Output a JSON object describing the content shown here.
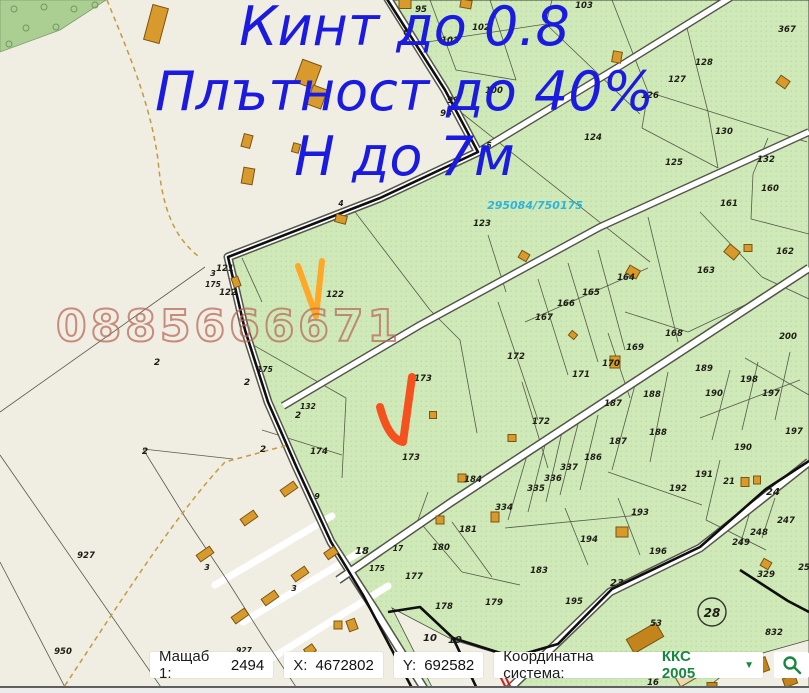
{
  "overlay": {
    "line1": "Кинт до 0.8",
    "line2": "Плътност до 40%",
    "line3": "Н до 7м",
    "note_color": "#1b1ae0",
    "watermark": "0885666671",
    "plot_id": "295084/750175",
    "check_orange": "#ffa726",
    "check_red": "#f4511e"
  },
  "map": {
    "colors": {
      "land": "#f0ede3",
      "parcel_green": "#cfe9b8",
      "forest": "#abce93",
      "road_fill": "#ffffff",
      "road_edge": "#53544a",
      "boundary": "#0f0f0f",
      "building": "#d89a2c",
      "label": "#1d1d15",
      "plot_id_color": "#2fb3d9"
    },
    "circled_parcel": "28",
    "labels": [
      {
        "t": "95",
        "x": 421,
        "y": 12
      },
      {
        "t": "102",
        "x": 481,
        "y": 30
      },
      {
        "t": "101",
        "x": 450,
        "y": 43
      },
      {
        "t": "103",
        "x": 584,
        "y": 8
      },
      {
        "t": "6",
        "x": 406,
        "y": 35,
        "s": 7.5
      },
      {
        "t": "100",
        "x": 494,
        "y": 93
      },
      {
        "t": "99",
        "x": 453,
        "y": 103
      },
      {
        "t": "98",
        "x": 446,
        "y": 116
      },
      {
        "t": "367",
        "x": 787,
        "y": 32
      },
      {
        "t": "128",
        "x": 704,
        "y": 65
      },
      {
        "t": "127",
        "x": 677,
        "y": 82
      },
      {
        "t": "126",
        "x": 650,
        "y": 98
      },
      {
        "t": "130",
        "x": 724,
        "y": 134
      },
      {
        "t": "5",
        "x": 489,
        "y": 148,
        "s": 8
      },
      {
        "t": "125",
        "x": 674,
        "y": 165
      },
      {
        "t": "124",
        "x": 593,
        "y": 140
      },
      {
        "t": "132",
        "x": 766,
        "y": 162
      },
      {
        "t": "160",
        "x": 770,
        "y": 191
      },
      {
        "t": "161",
        "x": 729,
        "y": 206
      },
      {
        "t": "162",
        "x": 785,
        "y": 254
      },
      {
        "t": "123",
        "x": 482,
        "y": 226
      },
      {
        "t": "4",
        "x": 341,
        "y": 206,
        "s": 7.5
      },
      {
        "t": "121",
        "x": 225,
        "y": 271
      },
      {
        "t": "3",
        "x": 213,
        "y": 276,
        "s": 8
      },
      {
        "t": "175",
        "x": 213,
        "y": 287,
        "s": 7.5
      },
      {
        "t": "122",
        "x": 228,
        "y": 295
      },
      {
        "t": "122",
        "x": 335,
        "y": 297
      },
      {
        "t": "163",
        "x": 706,
        "y": 273
      },
      {
        "t": "164",
        "x": 626,
        "y": 280
      },
      {
        "t": "165",
        "x": 591,
        "y": 295
      },
      {
        "t": "166",
        "x": 566,
        "y": 306
      },
      {
        "t": "167",
        "x": 544,
        "y": 320
      },
      {
        "t": "168",
        "x": 674,
        "y": 336
      },
      {
        "t": "169",
        "x": 635,
        "y": 350
      },
      {
        "t": "170",
        "x": 611,
        "y": 366
      },
      {
        "t": "171",
        "x": 581,
        "y": 377
      },
      {
        "t": "172",
        "x": 516,
        "y": 359
      },
      {
        "t": "172",
        "x": 541,
        "y": 424
      },
      {
        "t": "173",
        "x": 423,
        "y": 381
      },
      {
        "t": "173",
        "x": 411,
        "y": 460
      },
      {
        "t": "174",
        "x": 319,
        "y": 454
      },
      {
        "t": "175",
        "x": 265,
        "y": 372,
        "s": 7.5
      },
      {
        "t": "132",
        "x": 308,
        "y": 409,
        "s": 7.5
      },
      {
        "t": "2",
        "x": 298,
        "y": 418,
        "s": 9
      },
      {
        "t": "2",
        "x": 157,
        "y": 365,
        "s": 9
      },
      {
        "t": "2",
        "x": 247,
        "y": 385,
        "s": 9
      },
      {
        "t": "2",
        "x": 145,
        "y": 454,
        "s": 9
      },
      {
        "t": "2",
        "x": 263,
        "y": 452,
        "s": 9
      },
      {
        "t": "927",
        "x": 86,
        "y": 558
      },
      {
        "t": "927",
        "x": 244,
        "y": 653,
        "s": 7.5
      },
      {
        "t": "950",
        "x": 63,
        "y": 654
      },
      {
        "t": "3",
        "x": 207,
        "y": 570,
        "s": 8
      },
      {
        "t": "3",
        "x": 294,
        "y": 591,
        "s": 8
      },
      {
        "t": "9",
        "x": 317,
        "y": 499,
        "s": 8
      },
      {
        "t": "18",
        "x": 362,
        "y": 554,
        "s": 10
      },
      {
        "t": "175",
        "x": 377,
        "y": 571,
        "s": 7.5
      },
      {
        "t": "17",
        "x": 398,
        "y": 551,
        "s": 7.5
      },
      {
        "t": "184",
        "x": 473,
        "y": 482
      },
      {
        "t": "335",
        "x": 536,
        "y": 491
      },
      {
        "t": "336",
        "x": 553,
        "y": 481
      },
      {
        "t": "337",
        "x": 569,
        "y": 470
      },
      {
        "t": "334",
        "x": 504,
        "y": 510
      },
      {
        "t": "186",
        "x": 593,
        "y": 460
      },
      {
        "t": "187",
        "x": 613,
        "y": 406
      },
      {
        "t": "187",
        "x": 618,
        "y": 444
      },
      {
        "t": "188",
        "x": 652,
        "y": 397
      },
      {
        "t": "188",
        "x": 658,
        "y": 435
      },
      {
        "t": "189",
        "x": 704,
        "y": 371
      },
      {
        "t": "190",
        "x": 714,
        "y": 396
      },
      {
        "t": "190",
        "x": 743,
        "y": 450
      },
      {
        "t": "198",
        "x": 749,
        "y": 382
      },
      {
        "t": "197",
        "x": 771,
        "y": 396
      },
      {
        "t": "197",
        "x": 794,
        "y": 434
      },
      {
        "t": "200",
        "x": 788,
        "y": 339
      },
      {
        "t": "191",
        "x": 704,
        "y": 477
      },
      {
        "t": "192",
        "x": 678,
        "y": 491
      },
      {
        "t": "193",
        "x": 640,
        "y": 515
      },
      {
        "t": "194",
        "x": 589,
        "y": 542
      },
      {
        "t": "196",
        "x": 658,
        "y": 554
      },
      {
        "t": "195",
        "x": 574,
        "y": 604
      },
      {
        "t": "183",
        "x": 539,
        "y": 573
      },
      {
        "t": "181",
        "x": 468,
        "y": 532
      },
      {
        "t": "180",
        "x": 441,
        "y": 550
      },
      {
        "t": "177",
        "x": 414,
        "y": 579
      },
      {
        "t": "178",
        "x": 444,
        "y": 609
      },
      {
        "t": "179",
        "x": 494,
        "y": 605
      },
      {
        "t": "10",
        "x": 430,
        "y": 641,
        "s": 10
      },
      {
        "t": "19",
        "x": 455,
        "y": 643,
        "s": 10
      },
      {
        "t": "23",
        "x": 617,
        "y": 586,
        "s": 10
      },
      {
        "t": "24",
        "x": 773,
        "y": 495,
        "s": 10
      },
      {
        "t": "21",
        "x": 729,
        "y": 484
      },
      {
        "t": "249",
        "x": 741,
        "y": 545
      },
      {
        "t": "248",
        "x": 759,
        "y": 535
      },
      {
        "t": "247",
        "x": 786,
        "y": 523
      },
      {
        "t": "25",
        "x": 804,
        "y": 570
      },
      {
        "t": "329",
        "x": 766,
        "y": 577
      },
      {
        "t": "832",
        "x": 774,
        "y": 635
      },
      {
        "t": "53",
        "x": 656,
        "y": 626
      },
      {
        "t": "16",
        "x": 653,
        "y": 685
      },
      {
        "t": "295084/750175",
        "x": 535,
        "y": 209,
        "s": 11,
        "c": "#2fb3d9"
      }
    ]
  },
  "statusbar": {
    "scale_label": "Мащаб 1:",
    "scale_value": "2494",
    "x_label": "X:",
    "x_value": "4672802",
    "y_label": "Y:",
    "y_value": "692582",
    "crs_label": "Координатна система:",
    "crs_value": "ККС 2005",
    "accent": "#17883e"
  }
}
